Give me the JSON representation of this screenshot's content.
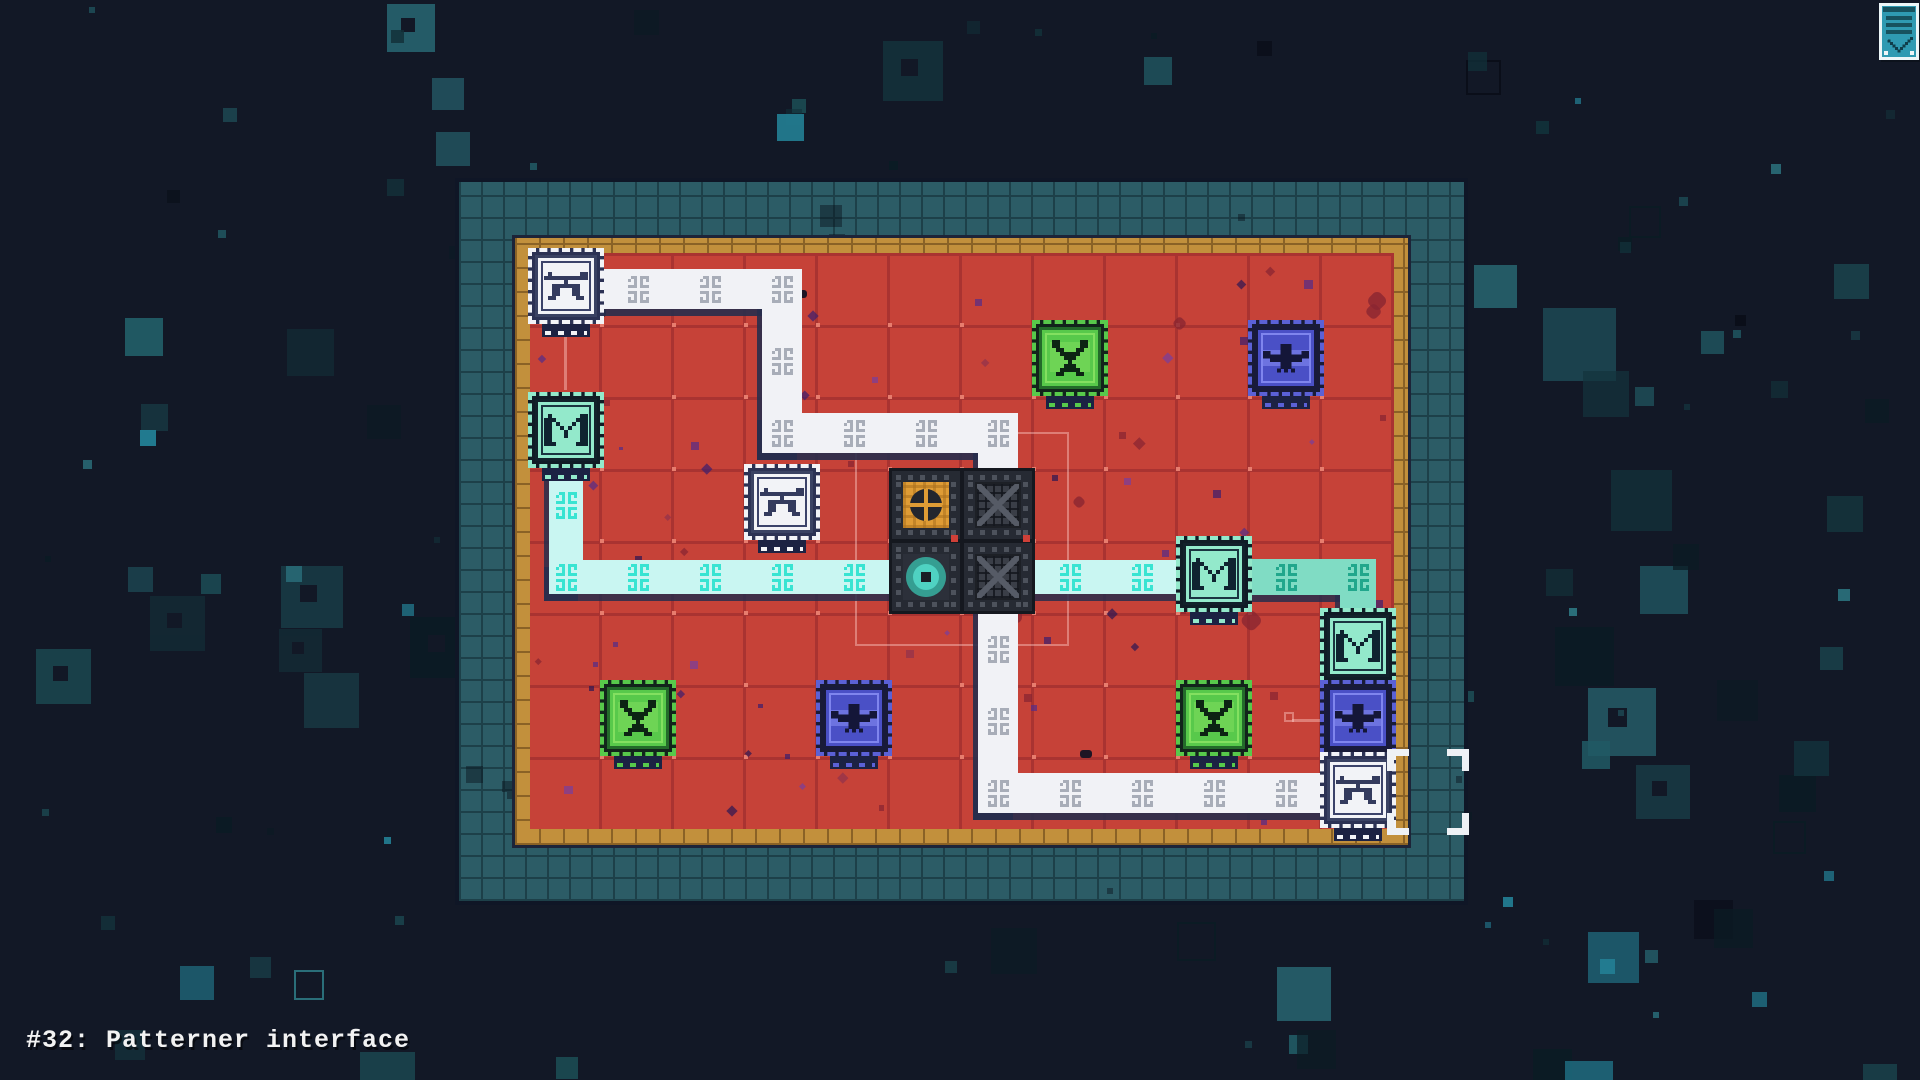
{
  "title": {
    "label": "#32: Patterner interface"
  },
  "hud": {
    "icon": "menu-panel-icon",
    "colors": {
      "body": "#2f9ab2",
      "frame": "#ecf6f8",
      "dark": "#17525f",
      "ink": "#0f3d4a"
    }
  },
  "board": {
    "x": 455,
    "y": 178,
    "w": 1013,
    "h": 727,
    "frame_thickness": 57,
    "border_thickness": 18,
    "cols": 12,
    "rows": 8,
    "cell": 72,
    "field": {
      "x": 530,
      "y": 253,
      "w": 864,
      "h": 576
    },
    "colors": {
      "frame": "#2c5c66",
      "frame_line": "#1d4049",
      "frame_edge": "#0f1626",
      "border": "#c2903c",
      "border_line": "#8a6226",
      "border_edge": "#1d2438",
      "field": "#c64238",
      "field_line": "#a93331",
      "field_dot": "#e77d6e"
    }
  },
  "paths": [
    {
      "id": "trace-white",
      "fill": "#f1f2f6",
      "orn_color": "#a8adb8",
      "width": 40,
      "shadow": "rgba(39,45,76,0.9)",
      "points": [
        [
          0,
          0
        ],
        [
          3,
          0
        ],
        [
          3,
          2
        ],
        [
          6,
          2
        ],
        [
          6,
          7
        ],
        [
          11,
          7
        ]
      ],
      "ornaments": [
        [
          1,
          0
        ],
        [
          2,
          0
        ],
        [
          3,
          0
        ],
        [
          3,
          1
        ],
        [
          3,
          2
        ],
        [
          4,
          2
        ],
        [
          5,
          2
        ],
        [
          6,
          2
        ],
        [
          6,
          5
        ],
        [
          6,
          6
        ],
        [
          6,
          7
        ],
        [
          7,
          7
        ],
        [
          8,
          7
        ],
        [
          9,
          7
        ],
        [
          10,
          7
        ]
      ]
    },
    {
      "id": "trace-cyan",
      "fill": "#c9f6f2",
      "orn_color": "#38e4d2",
      "width": 34,
      "shadow": "rgba(39,45,76,0.85)",
      "points": [
        [
          0,
          2
        ],
        [
          0,
          4
        ],
        [
          9,
          4
        ]
      ],
      "ornaments": [
        [
          0,
          3
        ],
        [
          0,
          4
        ],
        [
          1,
          4
        ],
        [
          2,
          4
        ],
        [
          3,
          4
        ],
        [
          4,
          4
        ],
        [
          7,
          4
        ],
        [
          8,
          4
        ]
      ]
    },
    {
      "id": "trace-teal",
      "fill": "#80dcc4",
      "orn_color": "#21a78c",
      "width": 36,
      "shadow": "rgba(39,45,76,0.85)",
      "points": [
        [
          9,
          4
        ],
        [
          11,
          4
        ],
        [
          11,
          5
        ]
      ],
      "ornaments": [
        [
          10,
          4
        ],
        [
          11,
          4
        ]
      ]
    }
  ],
  "tiles": [
    {
      "id": "machine-tile-orange-core",
      "type": "orange-core",
      "col": 5,
      "row": 3
    },
    {
      "id": "machine-tile-maze-a",
      "type": "maze",
      "col": 6,
      "row": 3
    },
    {
      "id": "machine-tile-teal-core",
      "type": "teal-core",
      "col": 5,
      "row": 4
    },
    {
      "id": "machine-tile-maze-b",
      "type": "maze",
      "col": 6,
      "row": 4
    }
  ],
  "palettes": {
    "white": {
      "body": "#f2f3f7",
      "edge": "#3a4263",
      "inner": "#3c436a",
      "glyph": "#343b5e",
      "plate": "#2c3254",
      "dash": "#f2f3f7"
    },
    "mint": {
      "body": "#93e9cb",
      "edge": "#12212b",
      "inner": "#1a3440",
      "glyph": "#0f2330",
      "plate": "#101c26",
      "dash": "#93e9cb"
    },
    "green": {
      "body": "#58c94b",
      "edge": "#236b2a",
      "inner": "#83e060",
      "glyph": "#0c2413",
      "plate": "#12241b",
      "dash": "#58c94b"
    },
    "indigo": {
      "body": "#4a50c6",
      "edge": "#181a3c",
      "inner": "#7f85ee",
      "glyph": "#141638",
      "plate": "#191b38",
      "dash": "#5b61d6"
    }
  },
  "nodes": [
    {
      "id": "node-anchor-top-left",
      "glyph": "anchor",
      "palette": "white",
      "col": 0,
      "row": 0
    },
    {
      "id": "node-chip-left",
      "glyph": "em",
      "palette": "mint",
      "col": 0,
      "row": 2
    },
    {
      "id": "node-anchor-mid",
      "glyph": "anchor",
      "palette": "white",
      "col": 3,
      "row": 3
    },
    {
      "id": "node-creature-top",
      "glyph": "wyrm",
      "palette": "green",
      "col": 7,
      "row": 1
    },
    {
      "id": "node-bird-top-right",
      "glyph": "bird",
      "palette": "indigo",
      "col": 10,
      "row": 1
    },
    {
      "id": "node-chip-mid-right",
      "glyph": "em",
      "palette": "mint",
      "col": 9,
      "row": 4
    },
    {
      "id": "node-chip-right-edge",
      "glyph": "em",
      "palette": "mint",
      "col": 11,
      "row": 5
    },
    {
      "id": "node-bird-right-edge",
      "glyph": "bird",
      "palette": "indigo",
      "col": 11,
      "row": 6
    },
    {
      "id": "node-anchor-bottom-right",
      "glyph": "anchor",
      "palette": "white",
      "col": 11,
      "row": 7
    },
    {
      "id": "node-creature-bottom-left",
      "glyph": "wyrm",
      "palette": "green",
      "col": 1,
      "row": 6
    },
    {
      "id": "node-bird-bottom-mid",
      "glyph": "bird",
      "palette": "indigo",
      "col": 4,
      "row": 6
    },
    {
      "id": "node-creature-bottom-right",
      "glyph": "wyrm",
      "palette": "green",
      "col": 9,
      "row": 6
    }
  ],
  "annotations": {
    "faint_color": "rgba(255,210,205,0.42)",
    "segments": [
      {
        "x": 564,
        "y": 322,
        "w": 3,
        "h": 68
      },
      {
        "x": 1292,
        "y": 719,
        "w": 32,
        "h": 3
      }
    ],
    "square": {
      "x": 1284,
      "y": 712,
      "size": 10
    },
    "rect": {
      "x": 855,
      "y": 432,
      "w": 214,
      "h": 214
    },
    "selection_brackets": {
      "x": 1387,
      "y": 749,
      "w": 82,
      "h": 86,
      "color": "#eef1f5",
      "arm": 22,
      "thick": 7
    },
    "tile_dots": [
      {
        "x": 951,
        "y": 535,
        "size": 7,
        "color": "#cf4038"
      },
      {
        "x": 1023,
        "y": 535,
        "size": 7,
        "color": "#cf4038"
      }
    ]
  },
  "speckles": {
    "count": 85,
    "colors": [
      "#7c3f98",
      "#5a2d84",
      "#93334b",
      "#43206b",
      "#8a2531",
      "#341a52"
    ]
  },
  "background": {
    "base": "#121826",
    "count": 175,
    "palette": [
      "#14333c",
      "#1b4750",
      "#215a64",
      "#2a6e79",
      "#0b1b24",
      "#0a0e19",
      "#123039",
      "#238095"
    ]
  }
}
